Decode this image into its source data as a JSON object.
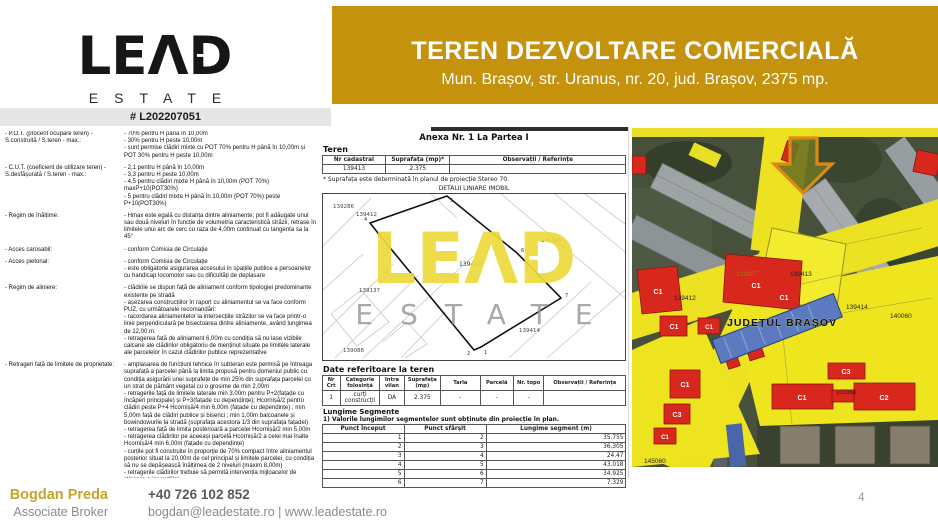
{
  "brand": {
    "le": "LE",
    "a": "Λ",
    "d": "D",
    "arrow": "→",
    "sub": "ESTATE"
  },
  "header": {
    "title": "TEREN DEZVOLTARE COMERCIALĂ",
    "subtitle": "Mun. Brașov, str. Uranus, nr. 20, jud. Brașov, 2375 mp.",
    "bg_color": "#C5920E"
  },
  "listing_ref": "# L202207051",
  "regulations": [
    {
      "label": "- P.O.T. (procent ocupare teren) -\nS.construită / S.teren - max.:",
      "items": [
        "- 70% pentru H până în 10,00m",
        "- 30% pentru H peste 10,00m",
        "- sunt permise clădiri mixte cu POT 70% pentru H până în 10,00m și POT 30% pentru H peste 10,00m"
      ]
    },
    {
      "label": "- C.U.T. (coeficient de utilizare teren) -\nS.desfășurată / S.teren - max.:",
      "items": [
        "- 2,1 pentru H până în 10,00m",
        "- 3,3 pentru H peste 10,00m",
        "- 4,5 pentru clădiri mixte H până în 10,00m (POT 70%) maxP+10(POT30%)",
        "- 5 pentru clădiri mixte H până în 10,00m (POT 70%) peste P+10(POT30%)"
      ]
    },
    {
      "label": "- Regim de înălțime:",
      "items": [
        "- Hmax este egală cu distanța dintre aliniamente; pot fi adăugate unul sau două niveluri în funcție de volumetria caracteristică străzii, retrase în limitele unui arc de cerc cu raza de 4,00m continuat cu tangenta sa la 45°"
      ]
    },
    {
      "label": "- Acces carosabil:",
      "items": [
        "- conform Comisia de Circulație"
      ]
    },
    {
      "label": "- Acces pietonal:",
      "items": [
        "- conform Comisia de Circulație",
        "- este obligatorie asigurarea accesului în spațiile publice a persoanelor cu handicap locomotor sau cu dificultăți de deplasare"
      ]
    },
    {
      "label": "- Regim de aliniere:",
      "items": [
        "- clădirile se dispun față de aliniament conform tipologiei predominante existente pe stradă",
        "- așezarea construcțiilor în raport cu aliniamentul se va face conform PUZ, cu următoarele recomandări:",
        "- racordarea aliniamentelor la intersecțiile străzilor se va face printr-o linie perpendiculară pe bisectoarea dintre aliniamente, având lungimea de 12,00 m.",
        "- retragerea față de aliniament 6,00m cu condiția să nu lase vizibile calcane ale clădirilor obligatoriu de menținut situate pe limitele laterale ale parcelelor în cazul clădirilor publice reprezentative"
      ]
    },
    {
      "label": "- Retrageri față de limitele de proprietate:",
      "items": [
        "- amplasarea de funcțiuni tehnice în subteran este permisă pe întreaga suprafață a parcelei până la limita propusă pentru domeniul public cu condiția asigurării unei suprafețe de min 25% din suprafața parcelei cu un strat de pământ vegetal cu o grosime de min 2,00m",
        "- retragerile față de limitele laterale min 3,00m pentru P+2(fațade cu încăperi principale) și P+3(fațade cu dependințe); Hcornișă/2 pentru clădiri peste P+4 Hcornișă/4 min 6,00m (fațade cu dependințe) ; min 5,00m față de clădiri publice și biserici ; min 1,00m balcoanele și bowindowurile la stradă (suprafața acestora 1/3 din suprafața fațadei)",
        "- retragerea față de limita posterioară a parcelei Hcornișă/2 min 5,00m",
        "- retragerea clădirilor pe aceeași parcelă Hcornișă/2 a celei mai înalte Hcornișă/4 min 6,00m (fațade cu dependințe)",
        "- curțile pot fi construite în proporție de 70% compact între aliniamentul posterior situat la 20,00m de cel principal și limitele parcelei, cu condiția să nu se depășească înălțimea de 2 niveluri (maxim 8,00m)",
        "- retragerile clădirilor trebuie să permită intervenția mijloacelor de stingere a incendiilor"
      ]
    }
  ],
  "cadastral": {
    "annex_title": "Anexa Nr. 1 La Partea I",
    "section_title": "Teren",
    "land_table": {
      "headers": [
        "Nr cadastral",
        "Suprafața (mp)*",
        "Observații / Referințe"
      ],
      "rows": [
        [
          "139413",
          "2.375",
          ""
        ]
      ]
    },
    "footnote": "* Suprafața este determinată în planul de proiecție Stereo 70.",
    "detail_title": "DETALII LINIARE IMOBIL",
    "plan_labels": {
      "p_139286": "139286",
      "p_139412": "139412",
      "p_139413": "139413",
      "p_145945": "145945",
      "p_139137": "139137",
      "p_139086": "139086",
      "p_139414": "139414"
    },
    "plan_vertices": [
      "1",
      "2",
      "3",
      "4",
      "5",
      "6",
      "7"
    ],
    "data_title": "Date referitoare la teren",
    "usage_table": {
      "headers": [
        "Nr Crt",
        "Categorie folosință",
        "Intra vilan",
        "Suprafața (mp)",
        "Tarla",
        "Parcelă",
        "Nr. topo",
        "Observații / Referințe"
      ],
      "rows": [
        [
          "1",
          "curți construcții",
          "DA",
          "2.375",
          "-",
          "-",
          "-",
          ""
        ]
      ]
    },
    "segments_title": "Lungime Segmente",
    "segments_note": "1) Valorile lungimilor segmentelor sunt obținute din proiecție în plan.",
    "segments_table": {
      "headers": [
        "Punct început",
        "Punct sfârșit",
        "Lungime segment (m)"
      ],
      "rows": [
        [
          "1",
          "2",
          "35.755"
        ],
        [
          "2",
          "3",
          "36.305"
        ],
        [
          "3",
          "4",
          "24.47"
        ],
        [
          "4",
          "5",
          "43.018"
        ],
        [
          "5",
          "6",
          "34.925"
        ],
        [
          "6",
          "7",
          "7.329"
        ]
      ]
    }
  },
  "map": {
    "region_label": "JUDEȚUL BRAȘOV",
    "labels": {
      "l_139412": "139412",
      "l_139413": "139413",
      "l_139107": "139107",
      "l_139414": "139414",
      "l_140060": "140060",
      "l_103368": "103368",
      "l_145060": "145060"
    },
    "c1": "C1",
    "c2": "C2",
    "c3": "C3",
    "colors": {
      "overlay_yellow": "#EFE51F",
      "building_red": "#D8271C",
      "building_blue": "#5B7ABF",
      "arrow_outline": "#DB8A13"
    }
  },
  "footer": {
    "name": "Bogdan Preda",
    "role": "Associate Broker",
    "phone": "+40 726 102 852",
    "contact": "bogdan@leadestate.ro | www.leadestate.ro",
    "page": "4"
  }
}
